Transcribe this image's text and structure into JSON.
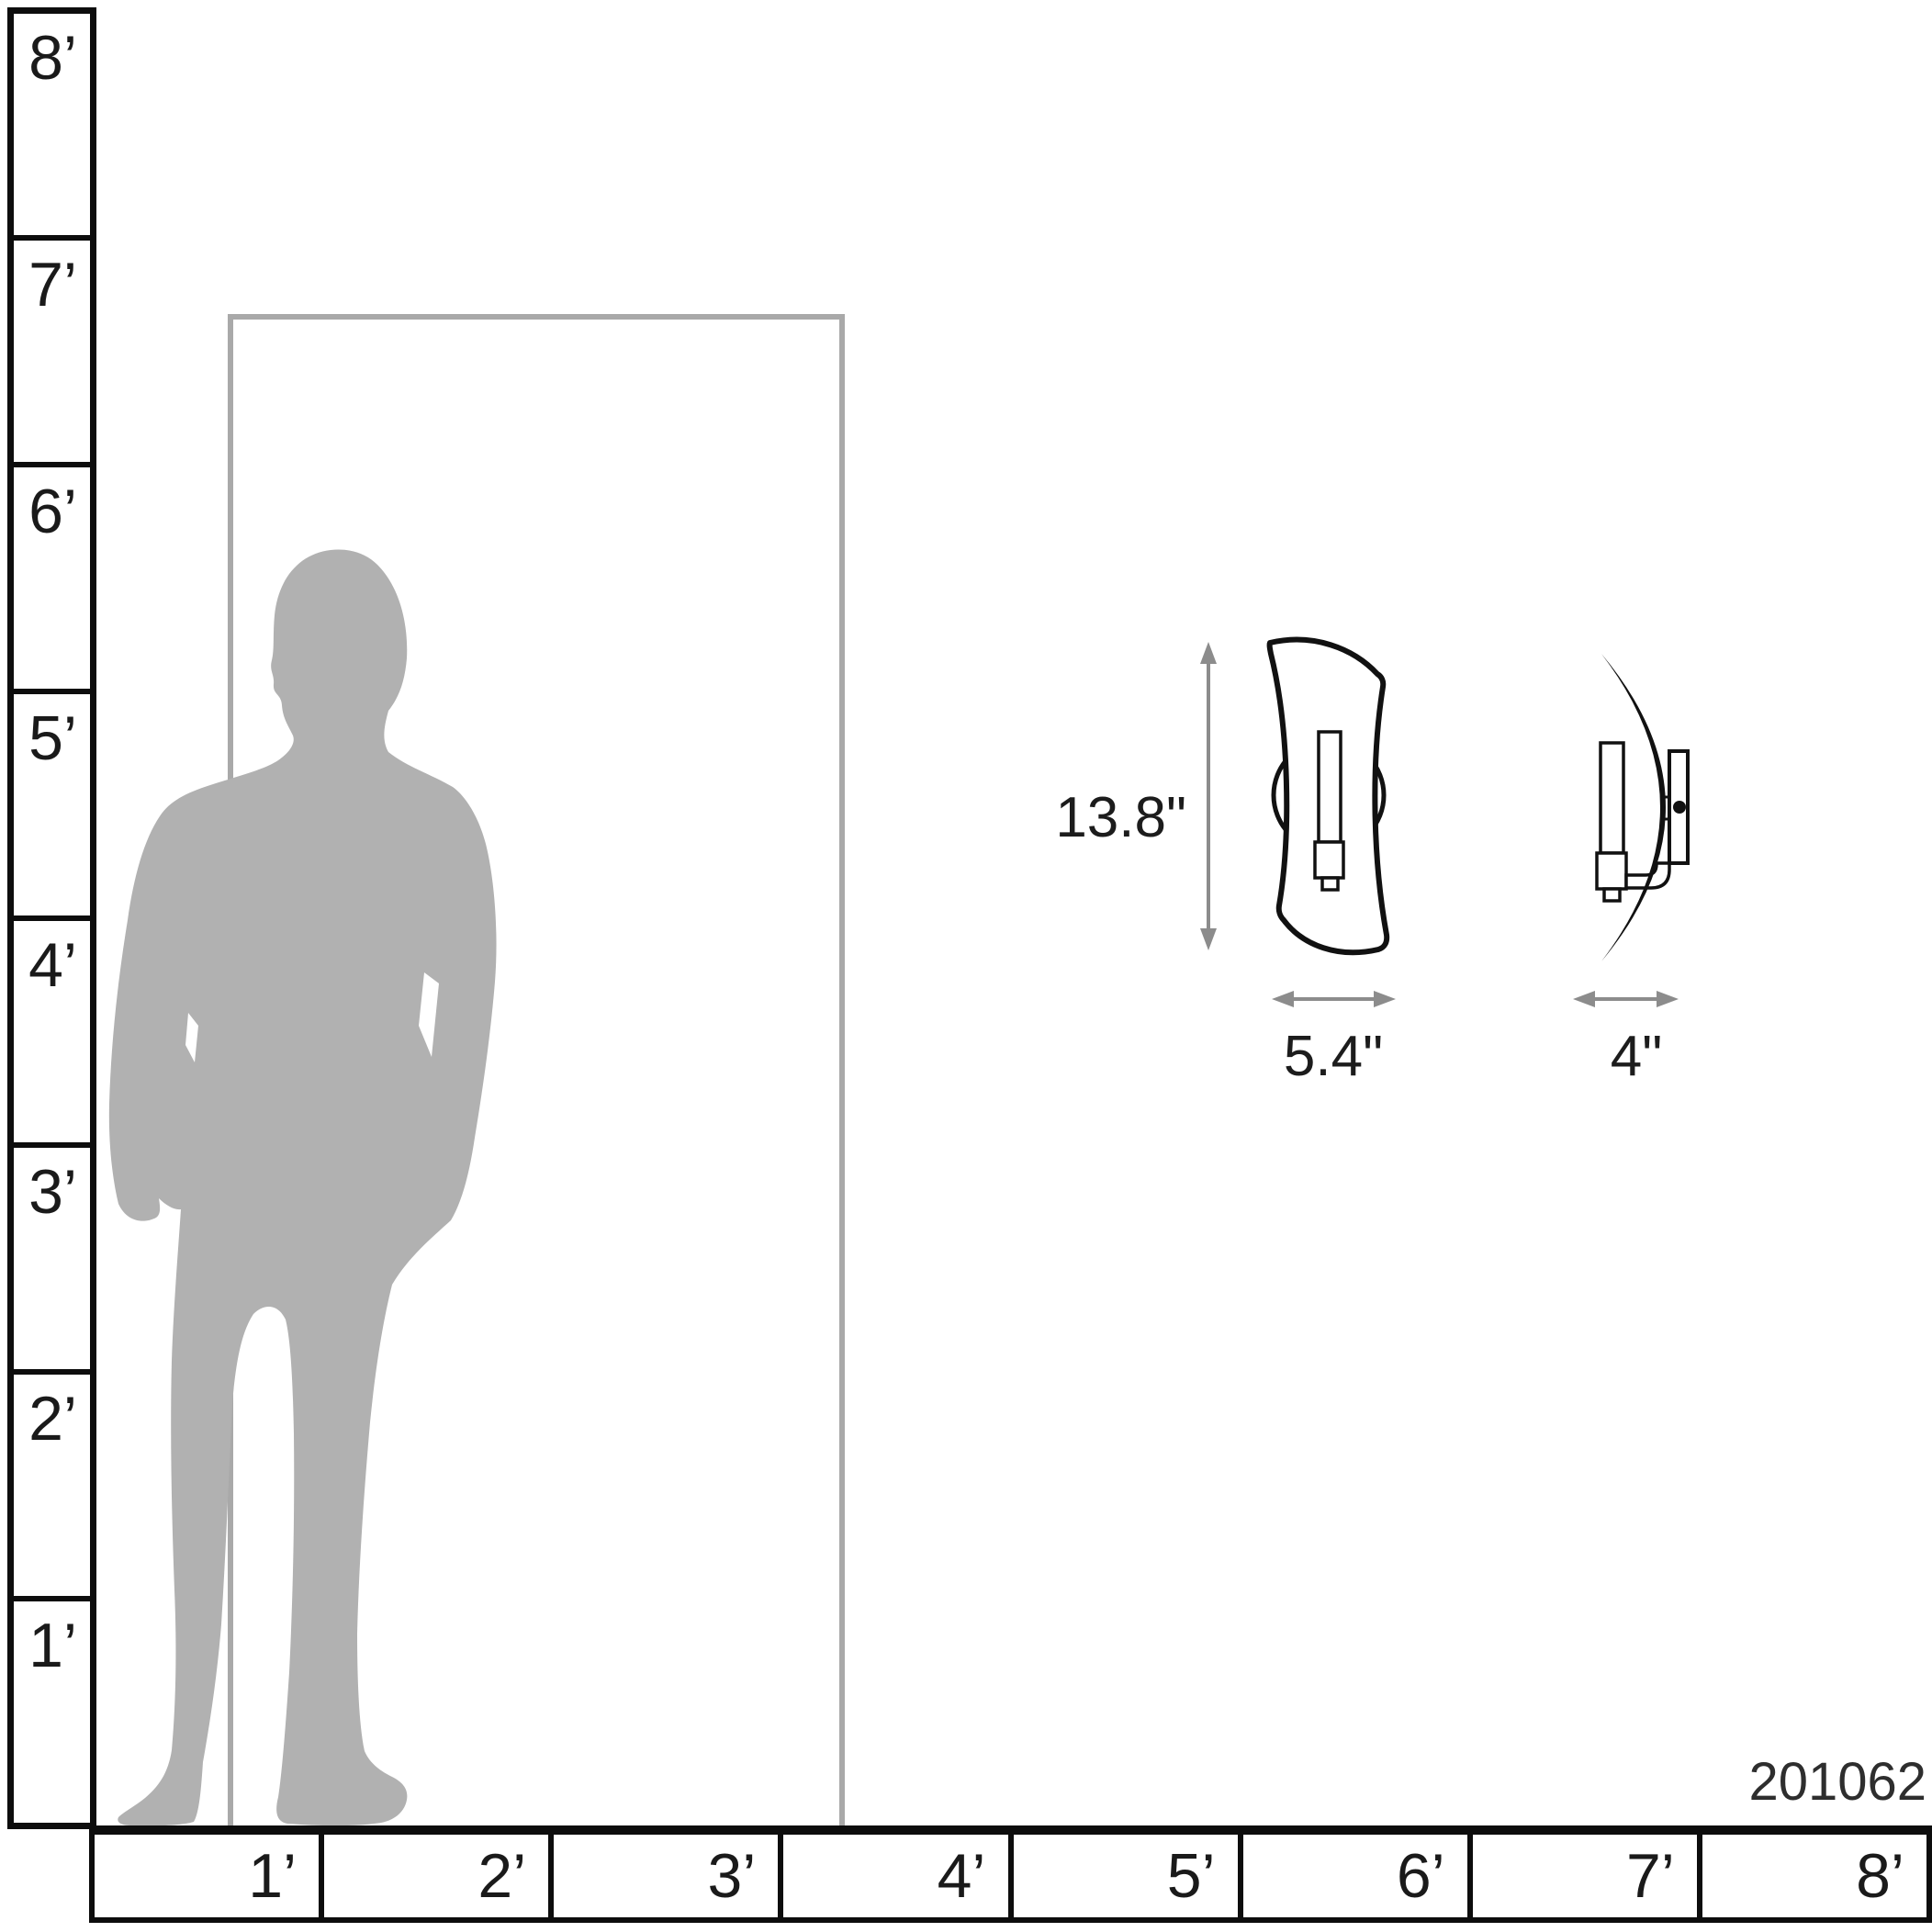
{
  "rulers": {
    "vertical": [
      "8’",
      "7’",
      "6’",
      "5’",
      "4’",
      "3’",
      "2’",
      "1’"
    ],
    "horizontal": [
      "1’",
      "2’",
      "3’",
      "4’",
      "5’",
      "6’",
      "7’",
      "8’"
    ],
    "unit": "feet"
  },
  "dimensions": {
    "height": "13.8\"",
    "width": "5.4\"",
    "depth": "4\""
  },
  "product_number": "201062",
  "figures": {
    "silhouette": "standing-man-silhouette",
    "door": "door-outline",
    "front_view": "sconce-front-view",
    "side_view": "sconce-side-view"
  },
  "icons": {
    "height_arrow": "vertical-dimension-arrow",
    "width_arrow": "horizontal-dimension-arrow",
    "depth_arrow": "horizontal-dimension-arrow"
  },
  "colors": {
    "line": "#0d0d0d",
    "sconce_line": "#111111",
    "door_outline": "#a9a9a9",
    "silhouette": "#b1b1b1",
    "arrow": "#8c8c8c",
    "text": "#1a1a1a"
  }
}
